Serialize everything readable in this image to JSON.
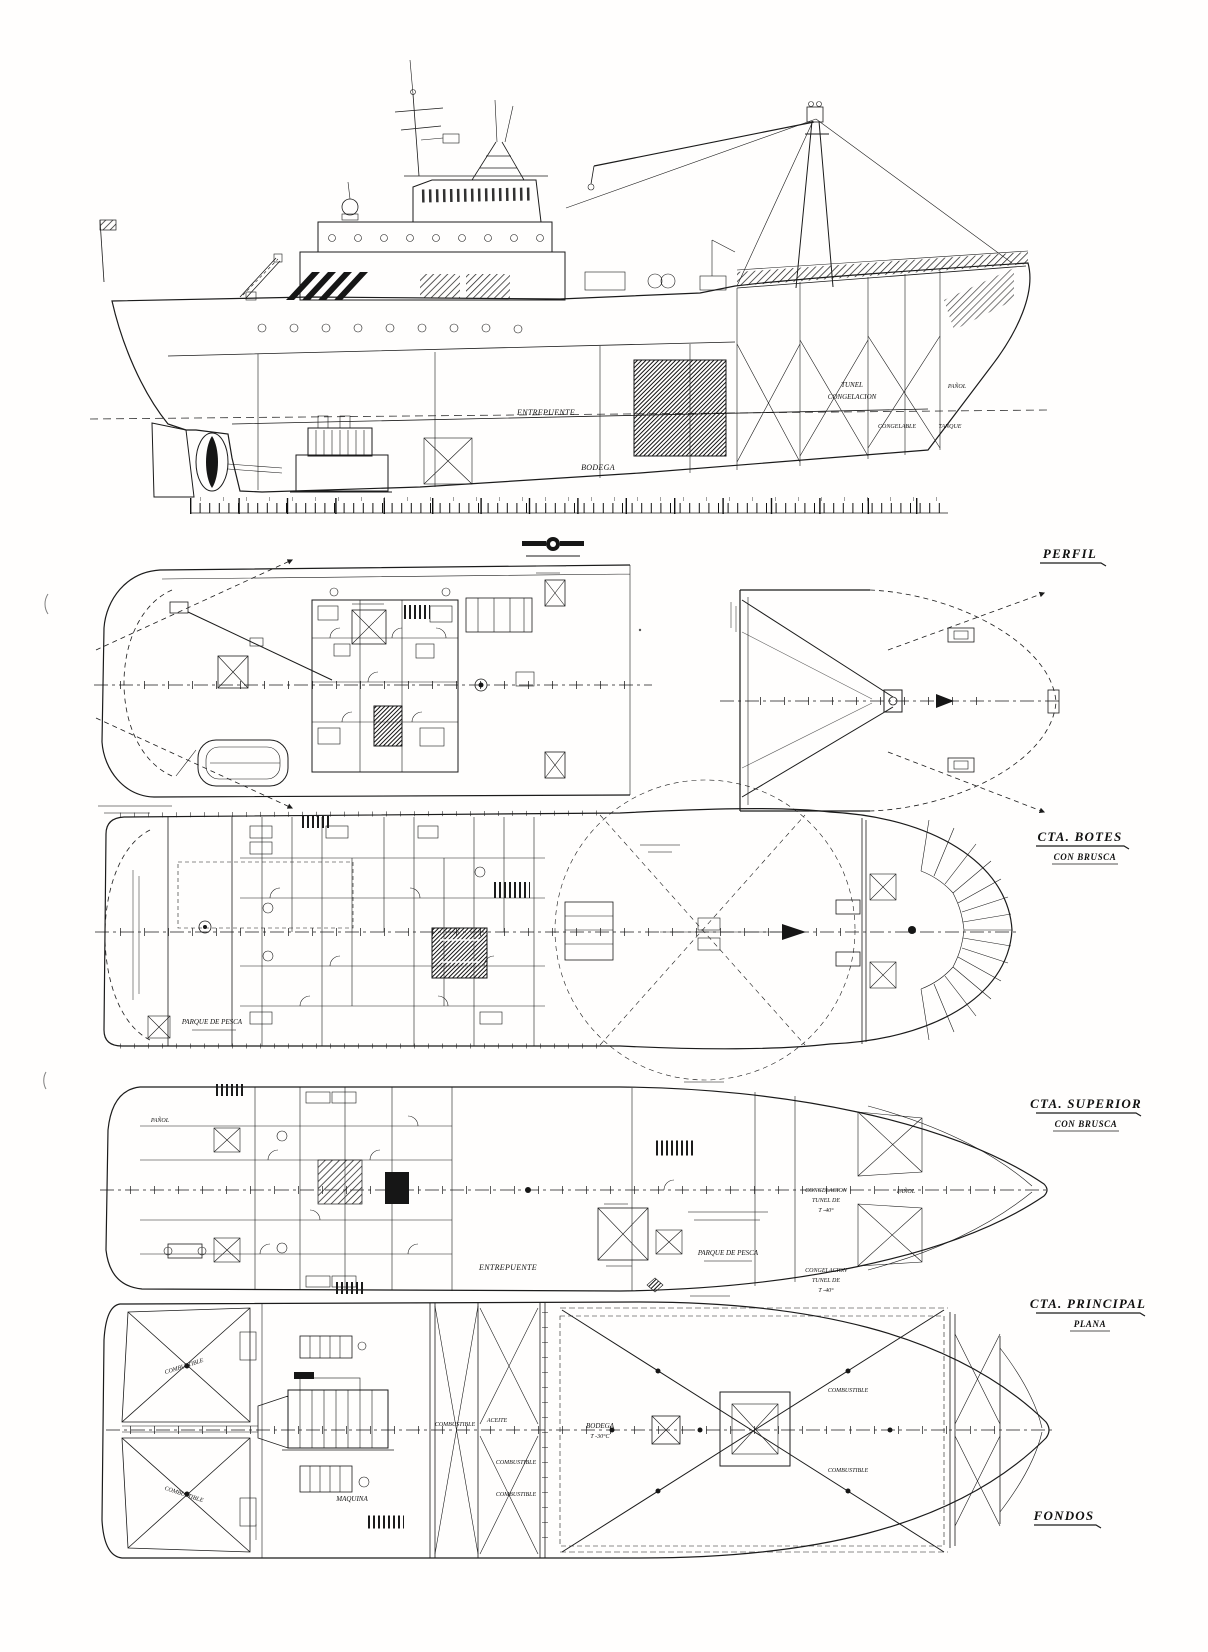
{
  "ink_color": "#1b1b1b",
  "views": {
    "perfil": {
      "title": "PERFIL",
      "labels": {
        "entrepuente": "ENTREPUENTE",
        "bodega": "BODEGA",
        "tunel_l1": "TUNEL",
        "tunel_l2": "CONGELACION",
        "panol": "PAÑOL",
        "congelable": "CONGELABLE",
        "tanque": "TANQUE"
      }
    },
    "botes": {
      "title": "CTA. BOTES",
      "subtitle": "CON BRUSCA"
    },
    "superior": {
      "title": "CTA. SUPERIOR",
      "subtitle": "CON BRUSCA",
      "labels": {
        "parque_pesca": "PARQUE DE PESCA"
      }
    },
    "principal": {
      "title": "CTA. PRINCIPAL",
      "subtitle": "PLANA",
      "labels": {
        "entrepuente": "ENTREPUENTE",
        "parque_pesca": "PARQUE DE PESCA",
        "cong_fwd_l1": "CONGELACION",
        "cong_fwd_l2": "TUNEL DE",
        "cong_fwd_l3": "T -40°",
        "cong_aft_l1": "CONGELACION",
        "cong_aft_l2": "TUNEL DE",
        "cong_aft_l3": "T -40°",
        "panol_aft": "PAÑOL",
        "panol_fwd": "PAÑOL"
      }
    },
    "fondos": {
      "title": "FONDOS",
      "labels": {
        "maquina": "MAQUINA",
        "bodega_l1": "BODEGA",
        "bodega_l2": "T -30°C",
        "aceite": "ACEITE",
        "combustible": [
          "COMBUSTIBLE",
          "COMBUSTIBLE",
          "COMBUSTIBLE",
          "COMBUSTIBLE",
          "COMBUSTIBLE",
          "COMBUSTIBLE",
          "COMBUSTIBLE"
        ]
      }
    }
  }
}
